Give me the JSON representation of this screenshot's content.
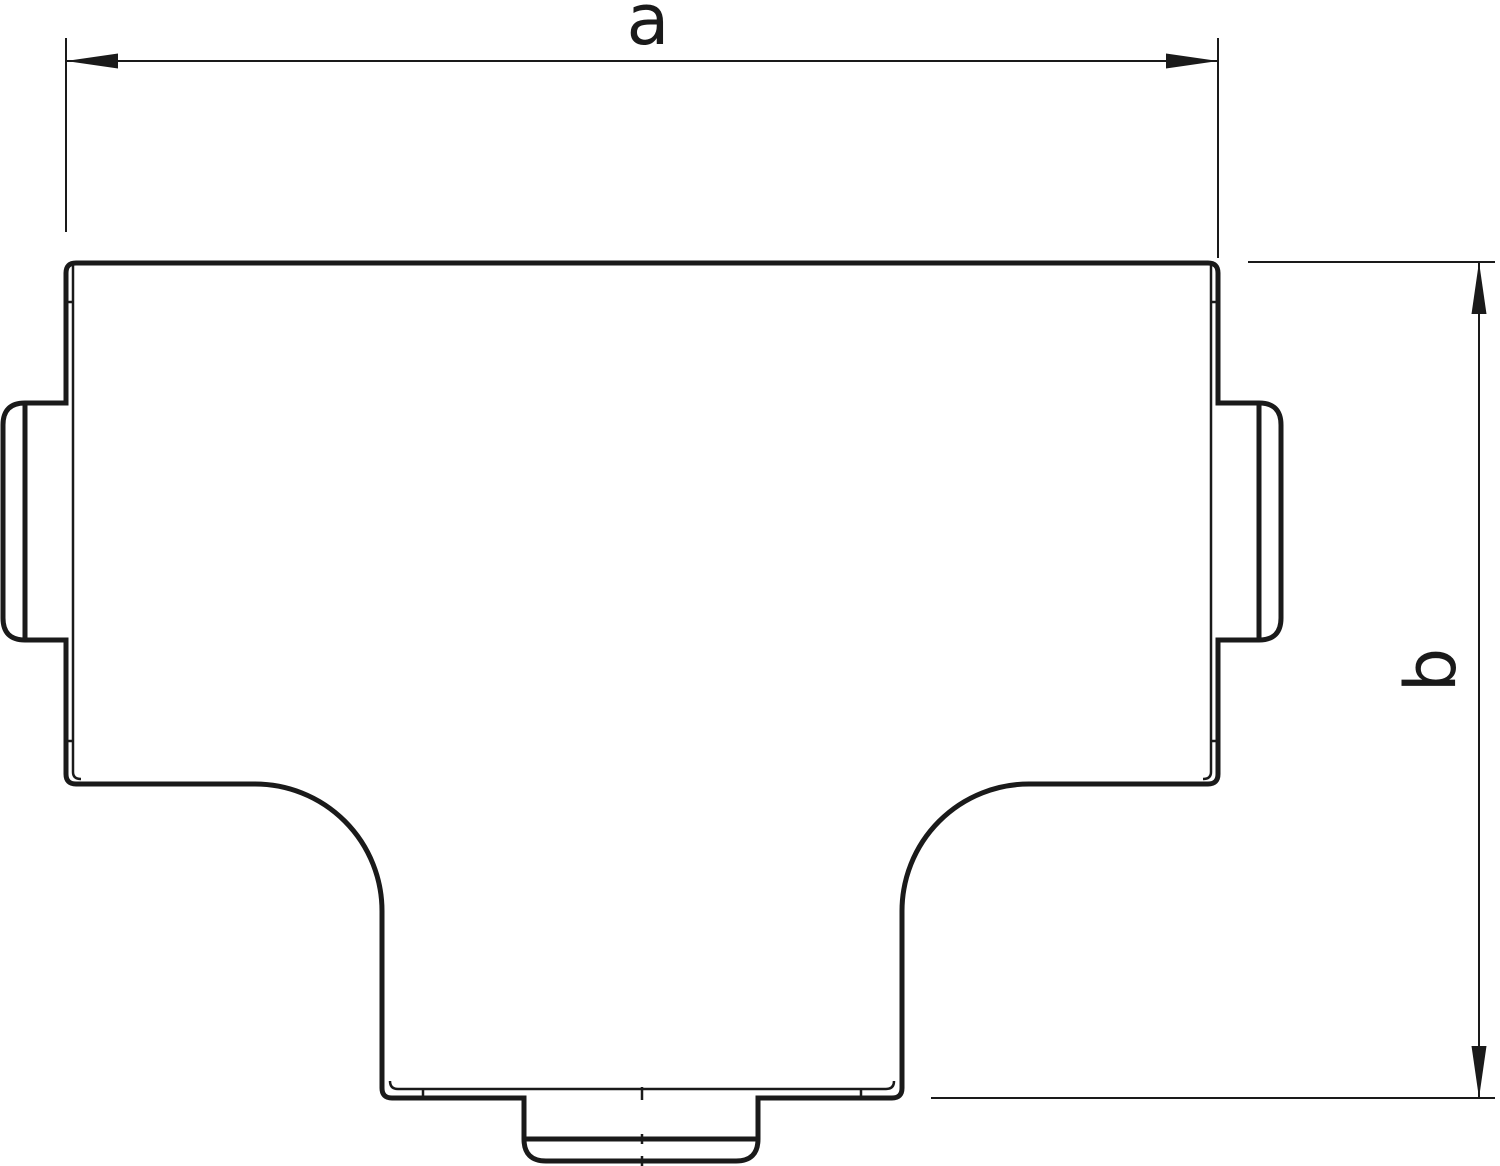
{
  "drawing": {
    "kind": "technical-dimension-drawing",
    "background_color": "#ffffff",
    "line_color": "#1a1a1a",
    "dimensions": {
      "a": {
        "label": "a",
        "orientation": "horizontal"
      },
      "b": {
        "label": "b",
        "orientation": "vertical"
      }
    }
  }
}
